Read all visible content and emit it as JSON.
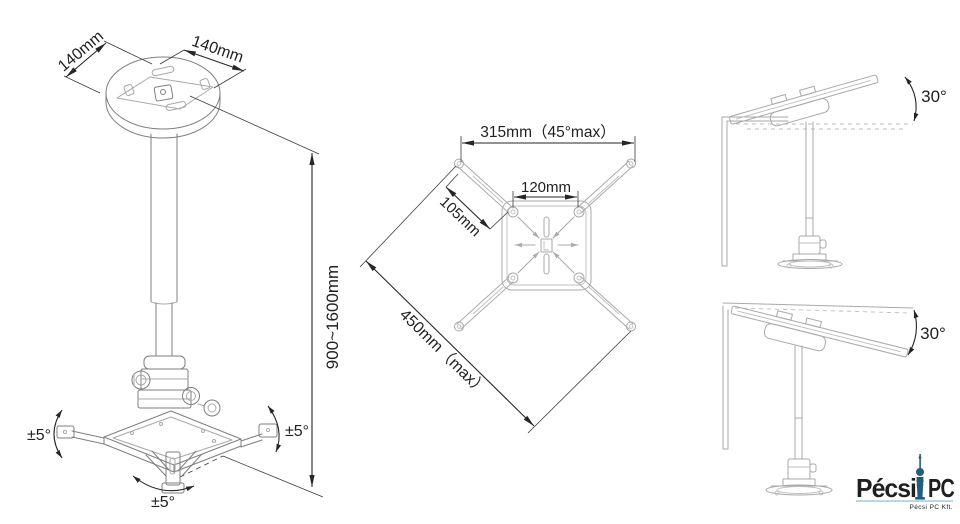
{
  "left_view": {
    "dim_plate_left": "140mm",
    "dim_plate_right": "140mm",
    "dim_height_range": "900~1600mm",
    "tilt_left": "±5°",
    "tilt_right": "±5°",
    "swivel_bottom": "±5°"
  },
  "top_view": {
    "dim_span_max": "315mm（45°max）",
    "dim_plate": "120mm",
    "dim_arm": "105mm",
    "dim_diagonal_max": "450mm（max）"
  },
  "tilt_up_view": {
    "angle": "30°"
  },
  "tilt_down_view": {
    "angle": "30°"
  },
  "logo": {
    "name_first": "Pécsi",
    "name_second": "PC",
    "company": "Pécsi PC Kft.",
    "color_primary": "#86b5cd",
    "color_tower": "#215e7e"
  }
}
